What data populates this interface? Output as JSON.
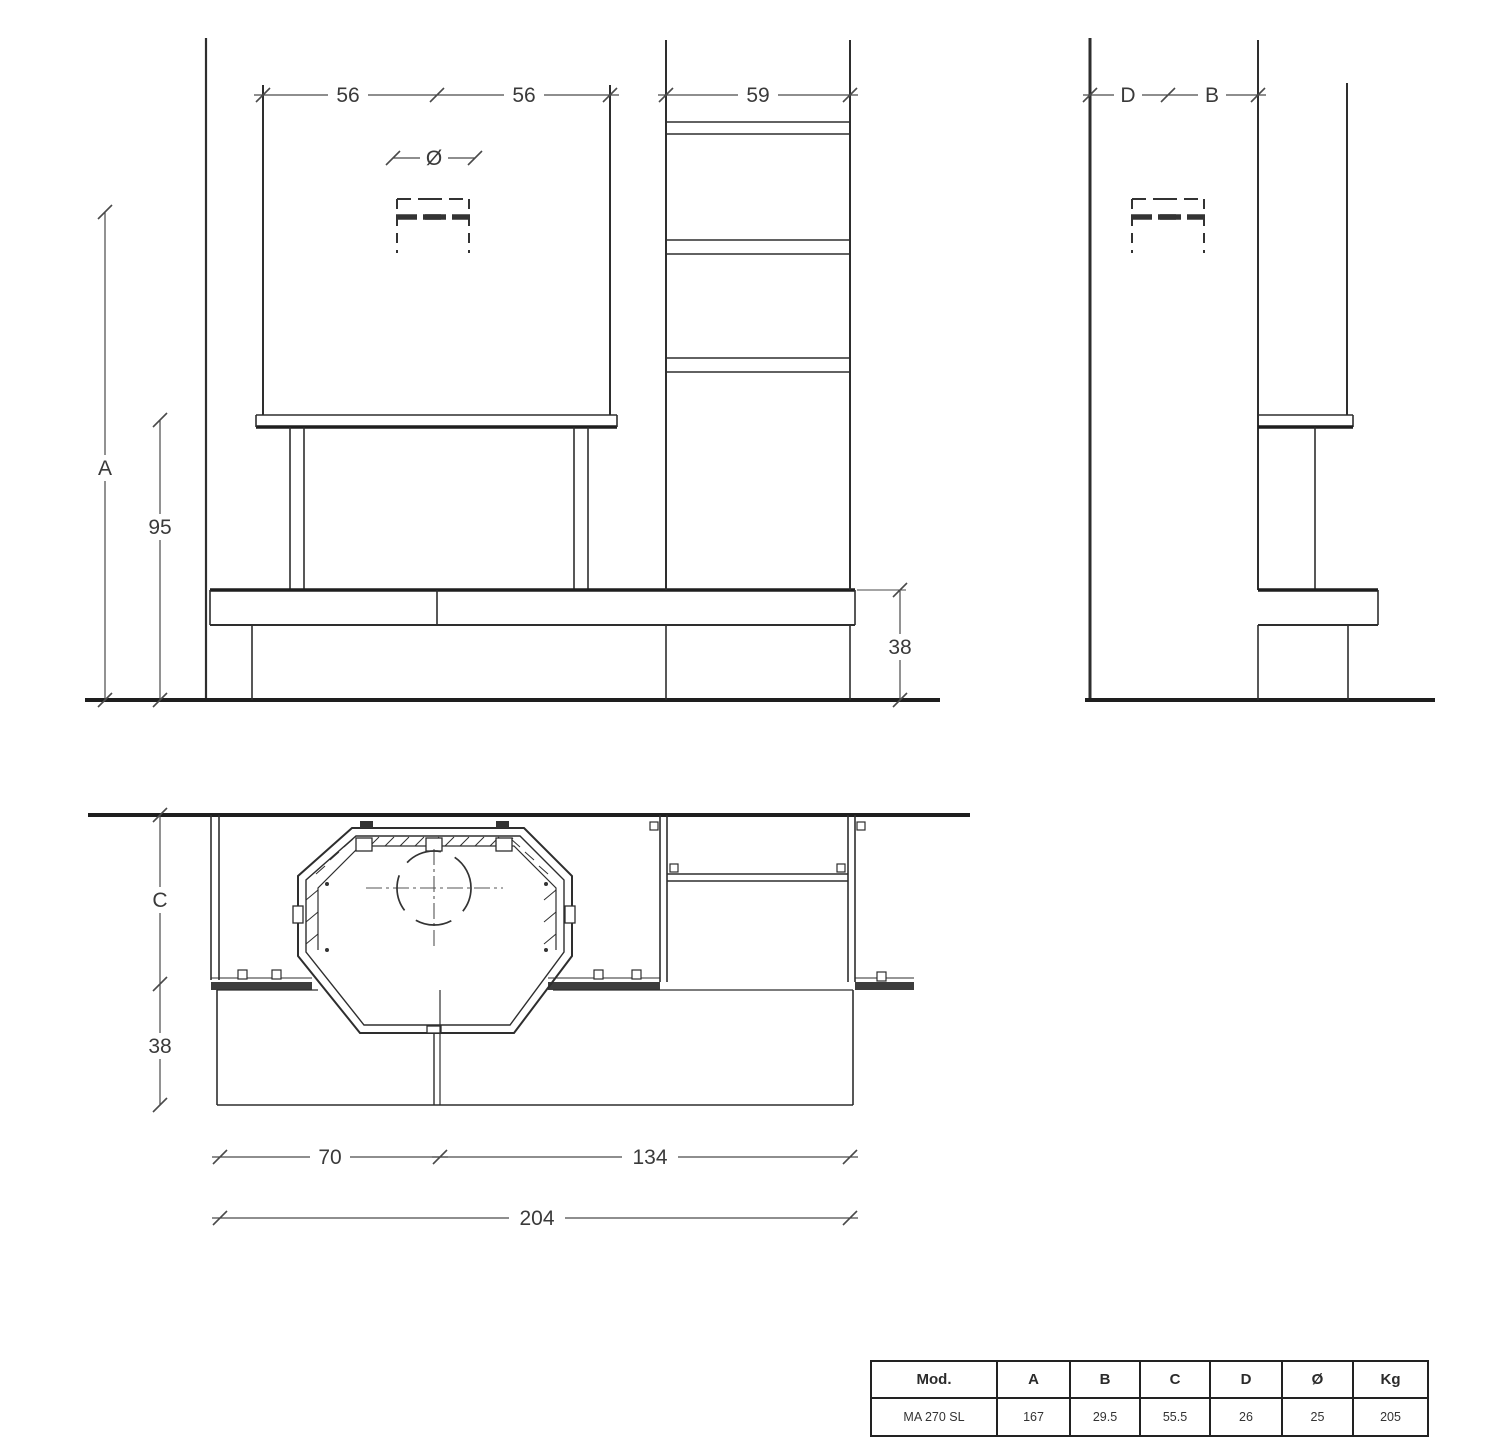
{
  "drawing_title": "Fireplace installation drawing MA 270 SL",
  "front_view": {
    "dim_hood_width_left": "56",
    "dim_hood_width_right": "56",
    "dim_chimney_width": "59",
    "dim_total_height": "A",
    "dim_hood_bottom_height": "95",
    "dim_bench_height": "38",
    "dim_flue_diameter": "Ø"
  },
  "side_view": {
    "dim_depth_back": "D",
    "dim_depth_front": "B"
  },
  "plan_view": {
    "dim_body_depth": "C",
    "dim_bench_depth": "38",
    "dim_left_section_width": "70",
    "dim_right_section_width": "134",
    "dim_total_width": "204"
  },
  "spec_table": {
    "headers": [
      "Mod.",
      "A",
      "B",
      "C",
      "D",
      "Ø",
      "Kg"
    ],
    "row": [
      "MA 270 SL",
      "167",
      "29.5",
      "55.5",
      "26",
      "25",
      "205"
    ]
  },
  "colors": {
    "object_line": "#2e2e2e",
    "heavy_line": "#1e1e1e",
    "dim_line": "#4a4a4a",
    "background": "#ffffff"
  }
}
